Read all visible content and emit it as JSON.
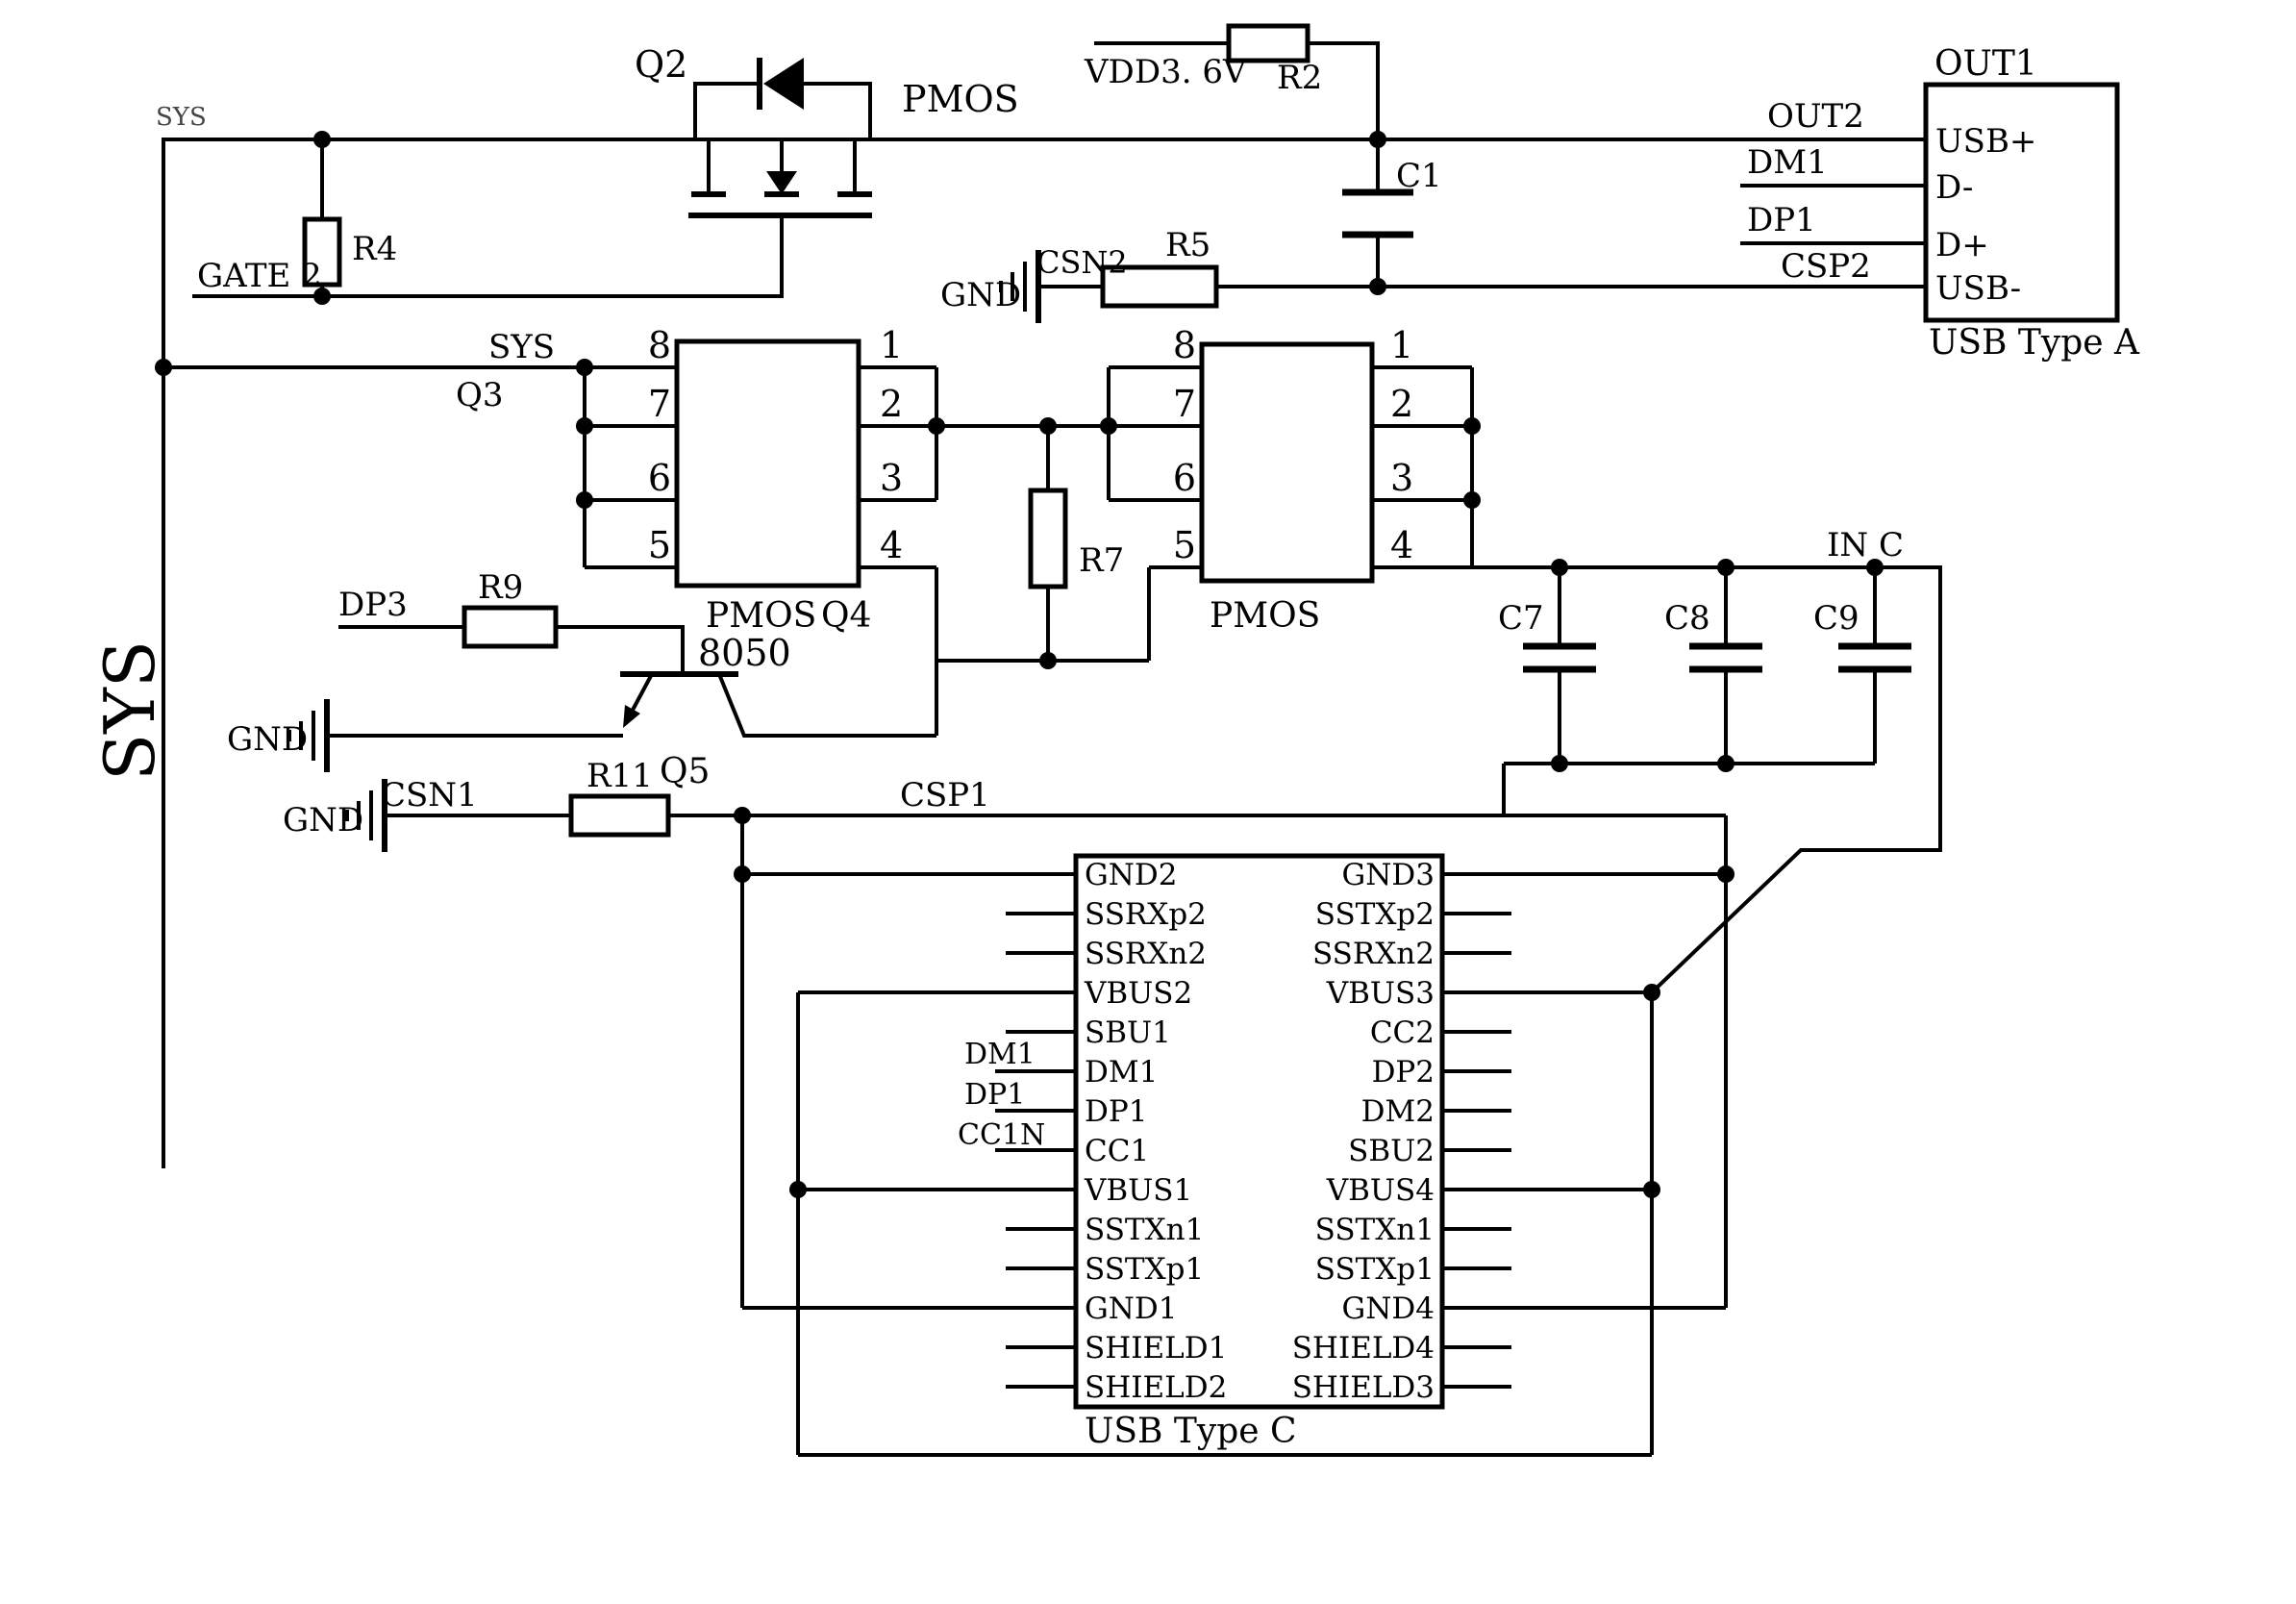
{
  "colors": {
    "ink": "#000000",
    "background": "#ffffff"
  },
  "labels": {
    "sys_big": "SYS",
    "sys_small": "SYS",
    "sys_chip": "SYS",
    "gate2": "GATE 2",
    "q2": "Q2",
    "pmos": "PMOS",
    "r4": "R4",
    "vdd": "VDD3. 6V",
    "r2": "R2",
    "c1": "C1",
    "gnd": "GND",
    "csn2": "CSN2",
    "r5": "R5",
    "out2": "OUT2",
    "dm1": "DM1",
    "dp1": "DP1",
    "csp2": "CSP2",
    "out1": "OUT1",
    "q3": "Q3",
    "q4": "Q4",
    "r7": "R7",
    "dp3": "DP3",
    "r9": "R9",
    "transistor_8050": "8050",
    "q5": "Q5",
    "csn1": "CSN1",
    "r11": "R11",
    "csp1": "CSP1",
    "in_c": "IN C",
    "c7": "C7",
    "c8": "C8",
    "c9": "C9",
    "cc1n": "CC1N"
  },
  "usb_a": {
    "title": "USB Type A",
    "pins": [
      "USB+",
      "D-",
      "D+",
      "USB-"
    ]
  },
  "usb_c": {
    "title": "USB Type C",
    "left_pins": [
      "GND2",
      "SSRXp2",
      "SSRXn2",
      "VBUS2",
      "SBU1",
      "DM1",
      "DP1",
      "CC1",
      "VBUS1",
      "SSTXn1",
      "SSTXp1",
      "GND1",
      "SHIELD1",
      "SHIELD2"
    ],
    "right_pins": [
      "GND3",
      "SSTXp2",
      "SSRXn2",
      "VBUS3",
      "CC2",
      "DP2",
      "DM2",
      "SBU2",
      "VBUS4",
      "SSTXn1",
      "SSTXp1",
      "GND4",
      "SHIELD4",
      "SHIELD3"
    ]
  },
  "pin_numbers": [
    "1",
    "2",
    "3",
    "4",
    "5",
    "6",
    "7",
    "8"
  ]
}
